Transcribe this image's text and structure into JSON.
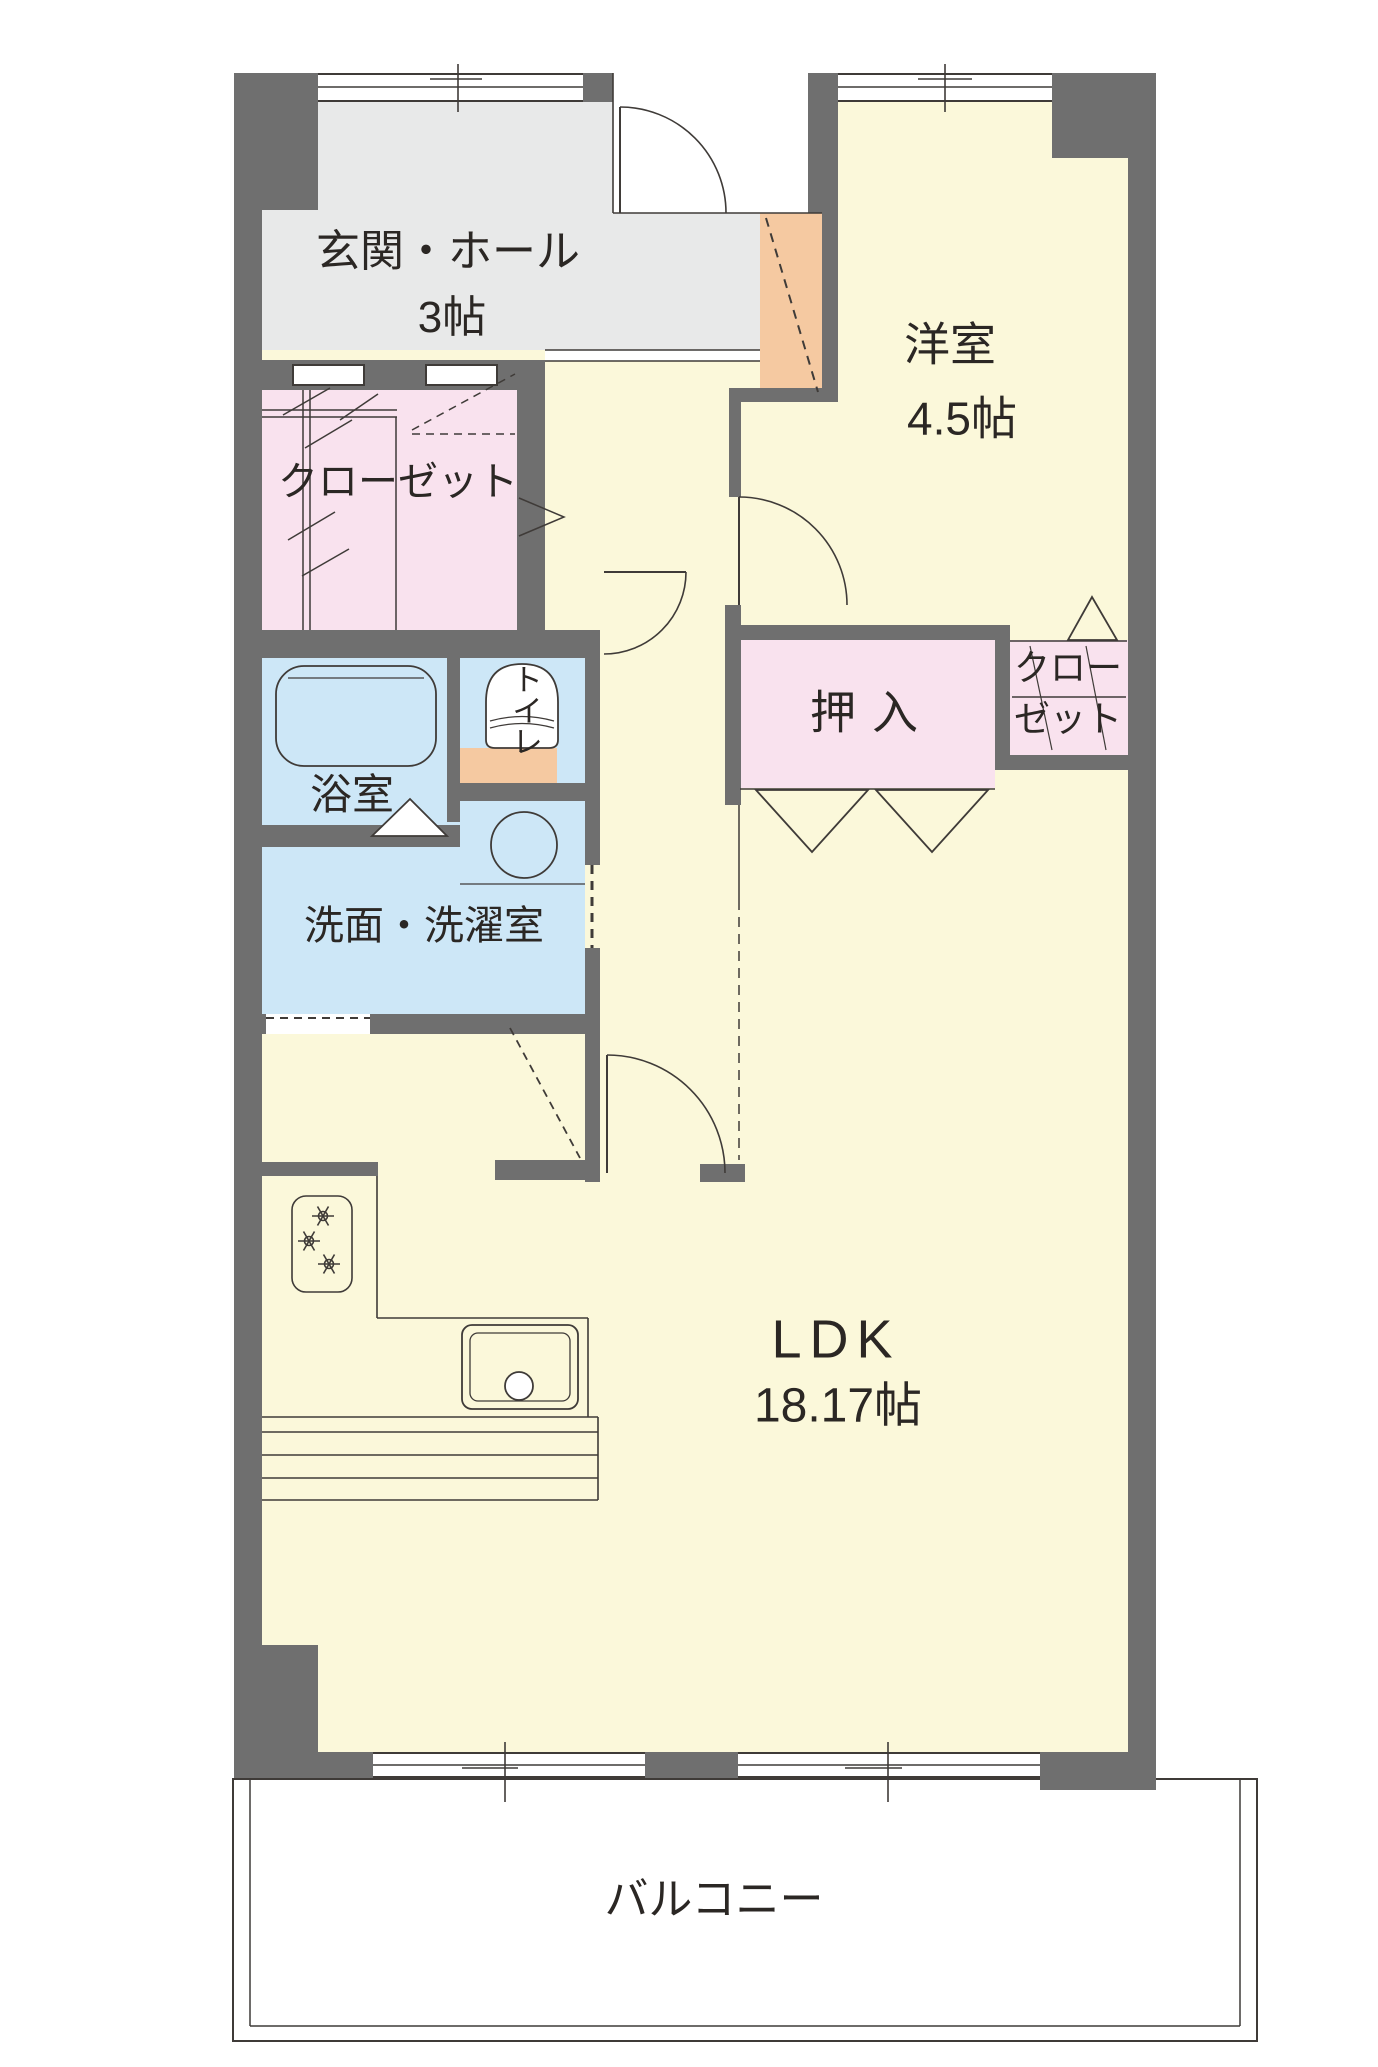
{
  "plan": {
    "rooms": {
      "entrance_hall": {
        "name": "玄関・ホール",
        "size": "3帖"
      },
      "western_room": {
        "name": "洋室",
        "size": "4.5帖"
      },
      "closet_left": {
        "name": "クローゼット"
      },
      "closet_right": {
        "line1": "クロー",
        "line2": "ゼット"
      },
      "oshiire": {
        "name": "押入"
      },
      "bathroom": {
        "name": "浴室"
      },
      "toilet": {
        "name": "トイレ"
      },
      "washroom": {
        "name": "洗面・洗濯室"
      },
      "ldk": {
        "name": "LDK",
        "size": "18.17帖"
      },
      "balcony": {
        "name": "バルコニー"
      }
    },
    "colors": {
      "wall": "#6f6f6f",
      "floor_yellow": "#fbf8da",
      "hall_gray": "#e8e9e9",
      "room_pink": "#f9e2ee",
      "room_blue": "#cde7f7",
      "cabinet_orange": "#f5c9a1",
      "line": "#3f3b38"
    }
  }
}
